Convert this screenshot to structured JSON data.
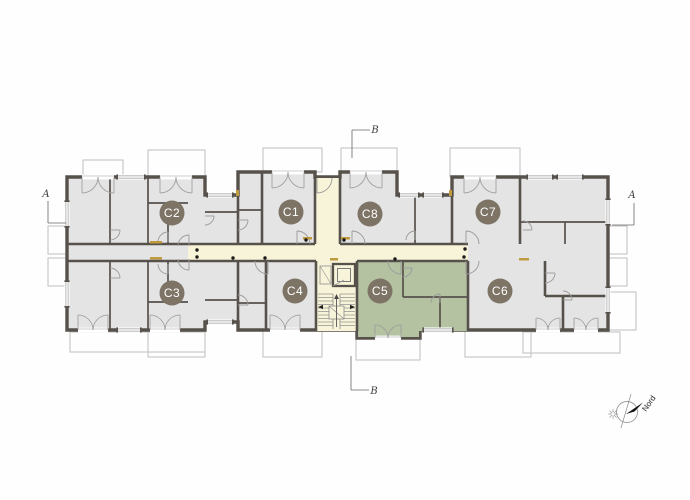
{
  "plan": {
    "apartments": [
      {
        "label": "C1",
        "cx": 291,
        "cy": 212,
        "highlighted": false
      },
      {
        "label": "C2",
        "cx": 172,
        "cy": 213,
        "highlighted": false
      },
      {
        "label": "C3",
        "cx": 172,
        "cy": 293,
        "highlighted": false
      },
      {
        "label": "C4",
        "cx": 295,
        "cy": 291,
        "highlighted": false
      },
      {
        "label": "C5",
        "cx": 380,
        "cy": 291,
        "highlighted": true
      },
      {
        "label": "C6",
        "cx": 500,
        "cy": 291,
        "highlighted": false
      },
      {
        "label": "C7",
        "cx": 488,
        "cy": 212,
        "highlighted": false
      },
      {
        "label": "C8",
        "cx": 370,
        "cy": 214,
        "highlighted": false
      }
    ],
    "section_markers": [
      {
        "label": "A",
        "position": "left",
        "tx": 46,
        "ty": 197
      },
      {
        "label": "A",
        "position": "right",
        "tx": 632,
        "ty": 198
      },
      {
        "label": "B",
        "position": "top",
        "tx": 375,
        "ty": 133
      },
      {
        "label": "B",
        "position": "bottom",
        "tx": 374,
        "ty": 394
      }
    ],
    "compass": {
      "label": "Nord"
    },
    "colors": {
      "wall": "#57514b",
      "room": "#e4e4e5",
      "corridor": "#f8f4d9",
      "highlight": "#b5c2a2",
      "badge": "#7d7466",
      "badge_text": "#ffffff",
      "thin_line": "#9a9a9a",
      "balcony_line": "#bfbfbf",
      "accent": "#c09a3e",
      "marker_text": "#3f3f3f"
    }
  }
}
